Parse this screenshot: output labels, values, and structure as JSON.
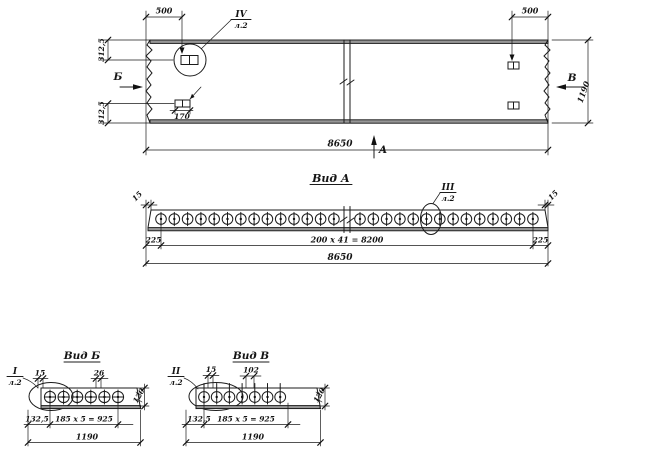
{
  "plan": {
    "dim_500_left": "500",
    "dim_500_right": "500",
    "dim_312_top": "312,5",
    "dim_312_bottom": "312,5",
    "dim_width": "1190",
    "dim_length": "8650",
    "dim_170": "170",
    "section_b": "Б",
    "section_v": "В",
    "section_a": "А",
    "detail_ref": {
      "num": "IV",
      "sheet": "л.2"
    }
  },
  "view_a": {
    "title": "Вид А",
    "dim_edge_left": "15",
    "dim_edge_right": "15",
    "dim_225_left": "225",
    "dim_spacing": "200 x 41 = 8200",
    "dim_225_right": "225",
    "dim_total": "8650",
    "detail_ref": {
      "num": "III",
      "sheet": "л.2"
    },
    "holes_left": 14,
    "holes_right": 14
  },
  "view_b": {
    "title": "Вид Б",
    "dim_edge": "15",
    "dim_26": "26",
    "dim_132": "132,5",
    "dim_spacing": "185 x 5 = 925",
    "dim_total": "1190",
    "dim_height": "120",
    "detail_ref": {
      "num": "I",
      "sheet": "л.2"
    },
    "holes": 6
  },
  "view_v": {
    "title": "Вид В",
    "dim_edge": "15",
    "dim_102": "102",
    "dim_132": "132,5",
    "dim_spacing": "185 x 5 = 925",
    "dim_total": "1190",
    "dim_height": "120",
    "detail_ref": {
      "num": "II",
      "sheet": "л.2"
    },
    "holes": 7
  }
}
